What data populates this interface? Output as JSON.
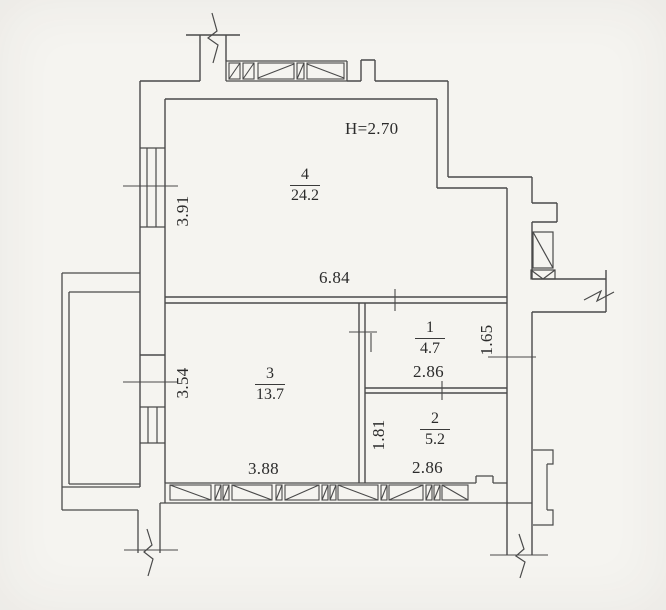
{
  "plan": {
    "title": "apartment-floor-plan",
    "ceiling_height": "H=2.70",
    "rooms": [
      {
        "number": "4",
        "area": "24.2"
      },
      {
        "number": "3",
        "area": "13.7"
      },
      {
        "number": "1",
        "area": "4.7"
      },
      {
        "number": "2",
        "area": "5.2"
      }
    ],
    "dimensions": {
      "hall_width": "6.84",
      "left_window_upper": "3.91",
      "left_window_lower": "3.54",
      "room3_width": "3.88",
      "room1_width": "2.86",
      "room1_depth": "1.65",
      "room2_width": "2.86",
      "room2_depth": "1.81"
    },
    "colors": {
      "paper": "#f5f4f0",
      "ink": "#4a4a4a",
      "text": "#2b2b2b"
    }
  }
}
